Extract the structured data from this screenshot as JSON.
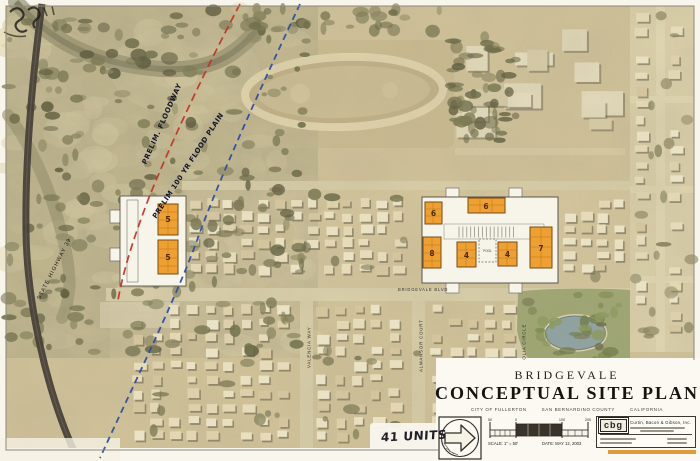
{
  "title_block": {
    "project": "BRIDGEVALE",
    "title": "CONCEPTUAL SITE PLAN",
    "location_city": "CITY OF FULLERTON",
    "location_county": "SAN BERNARDINO COUNTY",
    "location_state": "CALIFORNIA",
    "scale_label": "SCALE: 1\" = 50'",
    "date_label": "DATE: MAY 12, 2003",
    "scale_ticks": [
      "50",
      "0",
      "100",
      "200"
    ],
    "firm_logo": "cbg",
    "firm_name": "Curtin, Bacon & Gibson, Inc."
  },
  "annotations": {
    "units_note": "41 UNITS",
    "floodway_label": "PRELIM. FLOODWAY",
    "flood_plain_label": "PRELIM 100 YR FLOOD PLAIN",
    "highway_label": "STATE HIGHWAY 39",
    "pool_label": "POOL"
  },
  "streets": {
    "boulevard": "BRIDGEVALE BLVD",
    "south_1": "VALENCIA WAY",
    "south_2": "ALMANSOR COURT",
    "south_3": "MAGNOLIA CIRCLE"
  },
  "lots": {
    "left": [
      "5",
      "5"
    ],
    "right": [
      "6",
      "6",
      "8",
      "4",
      "4",
      "7"
    ]
  },
  "colors": {
    "building_fill": "#efa032",
    "floodway_line": "#c03527",
    "flood_plain_line": "#2c4fa3",
    "photo_base": "#d4c59a"
  }
}
